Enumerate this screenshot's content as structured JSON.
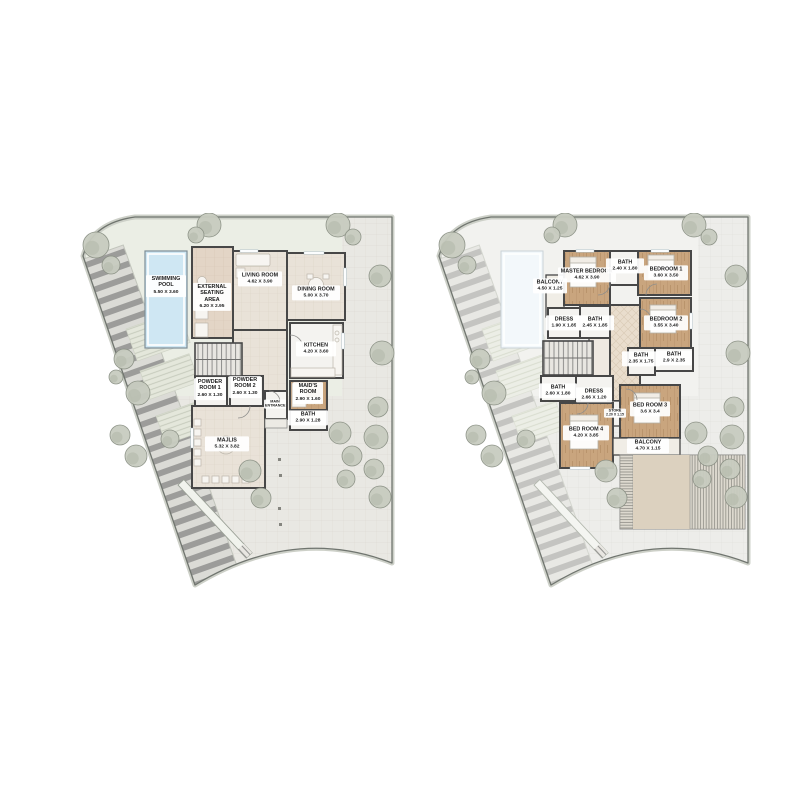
{
  "plans": [
    {
      "id": "ground-floor",
      "rooms": [
        {
          "label": "SWIMMING POOL",
          "dims": "5.50 X 3.60"
        },
        {
          "label": "EXTERNAL SEATING AREA",
          "dims": "6.20 X 2.95"
        },
        {
          "label": "LIVING ROOM",
          "dims": "4.62 X 3.90"
        },
        {
          "label": "DINING ROOM",
          "dims": "5.00 X 3.70"
        },
        {
          "label": "KITCHEN",
          "dims": "4.20 X 3.60"
        },
        {
          "label": "POWDER ROOM 1",
          "dims": "2.60 X 1.30"
        },
        {
          "label": "POWDER ROOM 2",
          "dims": "2.60 X 1.30"
        },
        {
          "label": "MAIN ENTRANCE",
          "dims": ""
        },
        {
          "label": "MAID'S ROOM",
          "dims": "2.90 X 1.60"
        },
        {
          "label": "BATH",
          "dims": "2.90 X 1.28"
        },
        {
          "label": "MAJLIS",
          "dims": "5.32 X 3.82"
        }
      ]
    },
    {
      "id": "first-floor",
      "rooms": [
        {
          "label": "BALCONY",
          "dims": "4.50 X 1.25"
        },
        {
          "label": "MASTER BEDROOM",
          "dims": "4.62 X 3.90"
        },
        {
          "label": "BATH",
          "dims": "2.40 X 1.80"
        },
        {
          "label": "BEDROOM 1",
          "dims": "3.60 X 3.50"
        },
        {
          "label": "DRESS",
          "dims": "1.90 X 1.85"
        },
        {
          "label": "BATH",
          "dims": "2.45 X 1.85"
        },
        {
          "label": "BEDROOM 2",
          "dims": "3.55 X 3.40"
        },
        {
          "label": "BATH",
          "dims": "2.35 X 1.75"
        },
        {
          "label": "BATH",
          "dims": "2.9 X 2.35"
        },
        {
          "label": "BATH",
          "dims": "2.60 X 1.80"
        },
        {
          "label": "DRESS",
          "dims": "2.66 X 1.20"
        },
        {
          "label": "STORE",
          "dims": "2.20 X 1.15"
        },
        {
          "label": "BED ROOM 3",
          "dims": "3.6 X 3.4"
        },
        {
          "label": "BED ROOM 4",
          "dims": "4.20 X 3.85"
        },
        {
          "label": "BALCONY",
          "dims": "4.70 X 1.15"
        }
      ]
    }
  ],
  "colors": {
    "wall": "#474747",
    "pool_water": "#cfe7f3",
    "wood_floor": "#c9a57e",
    "tile_floor": "#e9e2d8",
    "paving": "#e9e8e3",
    "site_green": "#ebeee5",
    "tree": "#c8ccc0",
    "pergola_panel": "#dcd1bf",
    "label_text": "#1c1c1c"
  }
}
